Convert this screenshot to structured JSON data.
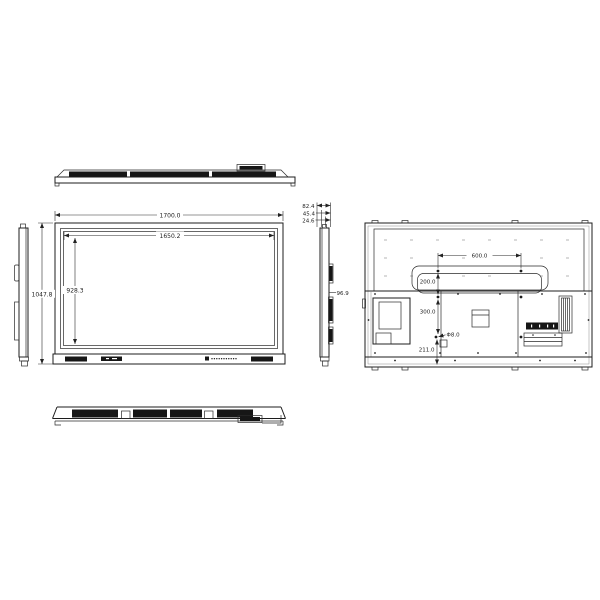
{
  "drawing": {
    "background": "#ffffff",
    "line_color": "#1c1c1c",
    "front": {
      "overall_width": "1700.0",
      "active_width": "1650.2",
      "overall_height": "1047.8",
      "active_height": "928.3"
    },
    "side": {
      "depth_total": "82.4",
      "depth_mid": "45.4",
      "depth_front": "24.6",
      "bracket_depth": "96.9"
    },
    "back": {
      "vesa_width": "600.0",
      "hole_offset_top": "200.0",
      "vesa_height": "300.0",
      "hole_diameter": "Φ8.0",
      "hole_offset_bottom": "211.0"
    }
  }
}
